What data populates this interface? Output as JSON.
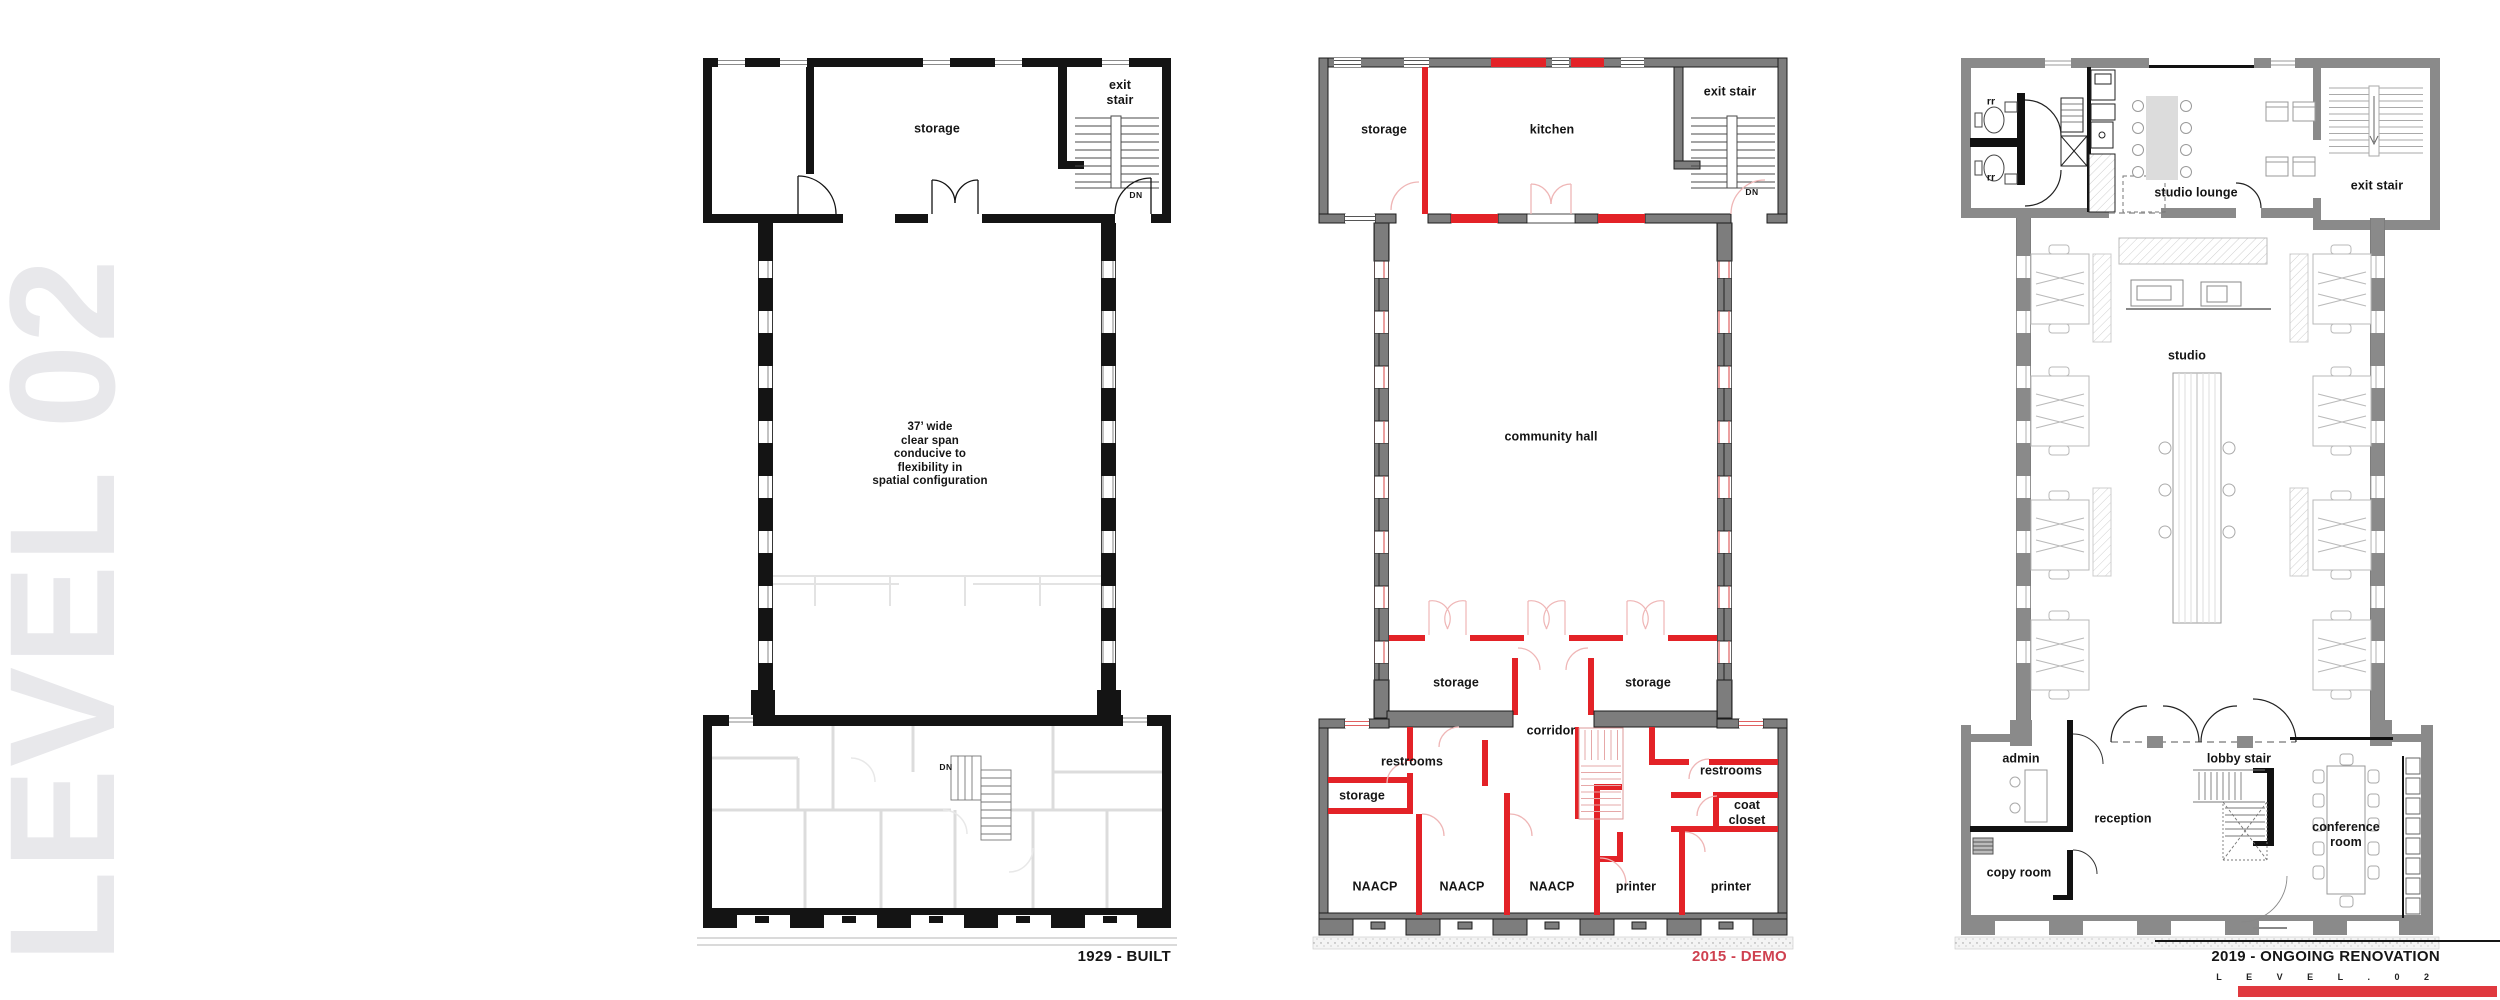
{
  "watermark": "LEVEL 02",
  "plans": {
    "built": {
      "caption": "1929 - BUILT",
      "rooms": {
        "storage": "storage",
        "exit_stair": "exit stair",
        "dn_top": "DN",
        "note": "37’ wide\nclear span\nconducive to\nflexibility in\nspatial configuration",
        "dn_bottom": "DN"
      }
    },
    "demo": {
      "caption": "2015 - DEMO",
      "rooms": {
        "storage": "storage",
        "kitchen": "kitchen",
        "exit_stair": "exit stair",
        "dn": "DN",
        "community_hall": "community hall",
        "storage_left": "storage",
        "storage_right": "storage",
        "corridor": "corridor",
        "restrooms_left": "restrooms",
        "restrooms_right": "restrooms",
        "storage_small": "storage",
        "coat_closet": "coat\ncloset",
        "naacp_1": "NAACP",
        "naacp_2": "NAACP",
        "naacp_3": "NAACP",
        "printer_1": "printer",
        "printer_2": "printer"
      }
    },
    "renovation": {
      "caption": "2019 - ONGOING RENOVATION",
      "rooms": {
        "rr_top": "rr",
        "rr_bottom": "rr",
        "studio_lounge": "studio lounge",
        "exit_stair": "exit stair",
        "studio": "studio",
        "admin": "admin",
        "lobby_stair": "lobby stair",
        "reception": "reception",
        "conference_room": "conference\nroom",
        "copy_room": "copy room"
      }
    }
  },
  "title_block": {
    "sheet_label": "L E V E L . 0 2"
  },
  "colors": {
    "demo_red": "#e32227",
    "caption_red": "#cf4150",
    "existing_gray": "#7d7d7d",
    "renovation_gray": "#8a8a8a",
    "built_black": "#141414",
    "watermark_gray": "#e8e8eb",
    "sheet_bar_red": "#e0393f"
  }
}
